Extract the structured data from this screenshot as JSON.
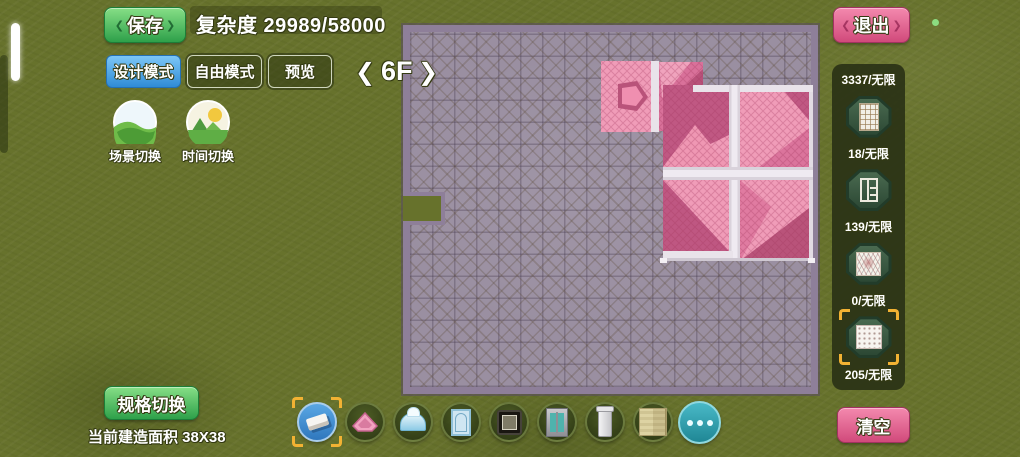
{
  "icons": {
    "chevron_left": "❮",
    "chevron_right": "❯"
  },
  "colors": {
    "grass": "#67722c",
    "save_green": "#2ea04a",
    "design_blue": "#2f8bd6",
    "exit_pink": "#d14a7b",
    "grid_base": "#9a8fa1",
    "grid_border": "#8e7f99",
    "roof_light": "#f09cb8",
    "roof_mid": "#d9719a",
    "roof_dark": "#bb5480",
    "beam_white": "#e9e3ea",
    "selection_yellow": "#f2b233",
    "more_teal": "#2e9fae"
  },
  "top_bar": {
    "save": "保存",
    "complexity": "复杂度 29989/58000",
    "exit": "退出"
  },
  "mode_bar": {
    "design": "设计模式",
    "free": "自由模式",
    "preview": "预览"
  },
  "floor_selector": {
    "label": "6F"
  },
  "toggles": {
    "scene": "场景切换",
    "time": "时间切换"
  },
  "right_panel": {
    "counts": [
      "3337/无限",
      "18/无限",
      "139/无限",
      "0/无限",
      "205/无限"
    ]
  },
  "bottom_bar": {
    "spec": "规格切换",
    "area": "当前建造面积 38X38",
    "clear": "清空"
  }
}
